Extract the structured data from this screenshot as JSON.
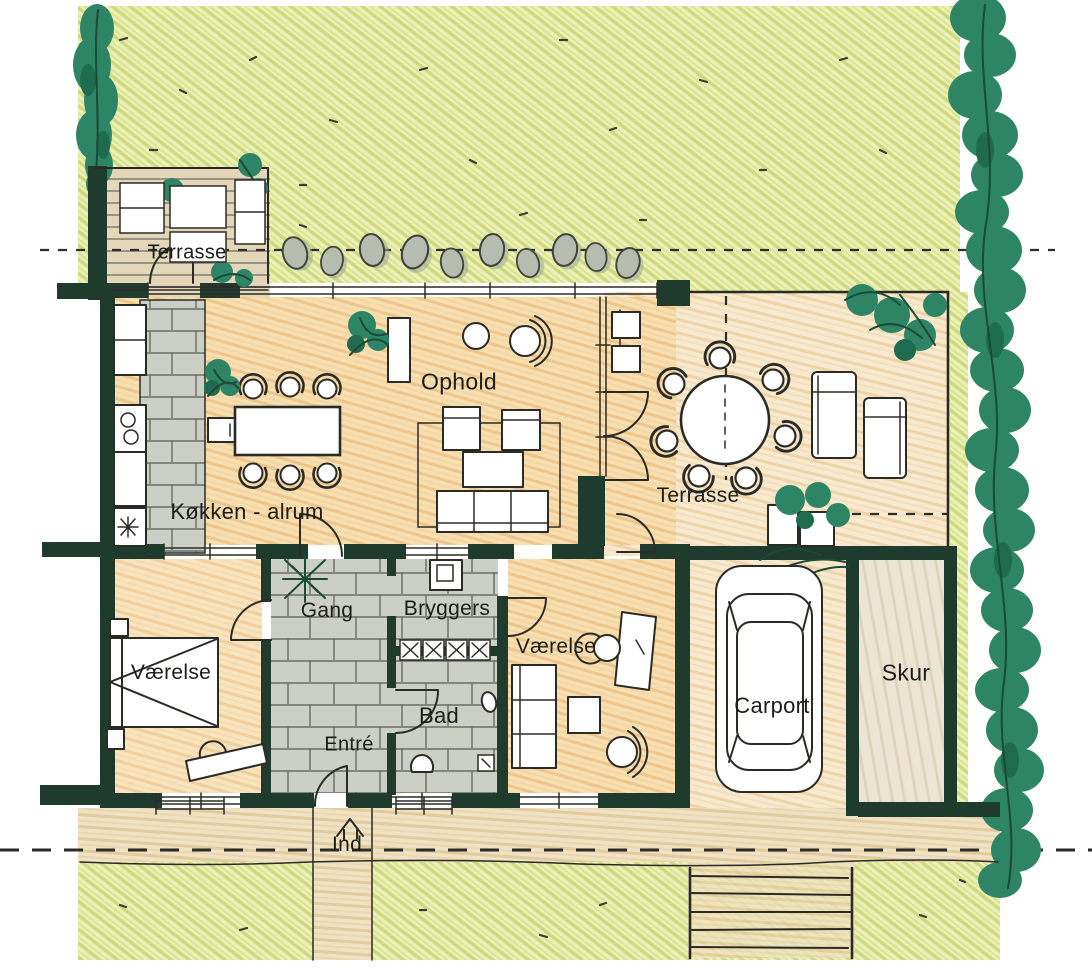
{
  "plan": {
    "labels": {
      "terrasse_nw": "Terrasse",
      "ophold": "Ophold",
      "kokken_alrum": "Køkken - alrum",
      "gang": "Gang",
      "bryggers": "Bryggers",
      "vaerelse_vest": "Værelse",
      "vaerelse_ost": "Værelse",
      "bad": "Bad",
      "entre": "Entré",
      "terrasse_ost": "Terrasse",
      "carport": "Carport",
      "skur": "Skur",
      "ind": "Ind"
    },
    "colors": {
      "lawn": "#ebf0bd",
      "lawn_hatch": "#cdda7c",
      "foliage": "#2e8566",
      "foliage_dark": "#1f6b50",
      "wall": "#1e3b2d",
      "ink": "#2b2b26",
      "floor_interior": "#f7dfb2",
      "floor_terrace": "#f8ead0",
      "tile_grey": "#cccfc6",
      "stone_grey": "#b6bdb0",
      "path_tan": "#f0e2c4",
      "paper": "#ffffff"
    },
    "icons": {
      "tree": "tree-icon",
      "hedge": "hedge-icon",
      "plant": "plant-icon",
      "stepping_stone": "stepping-stone-icon",
      "car": "car-icon",
      "entrance_arrow": "entrance-arrow-icon",
      "stove": "stove-icon",
      "sink": "sink-icon"
    }
  }
}
